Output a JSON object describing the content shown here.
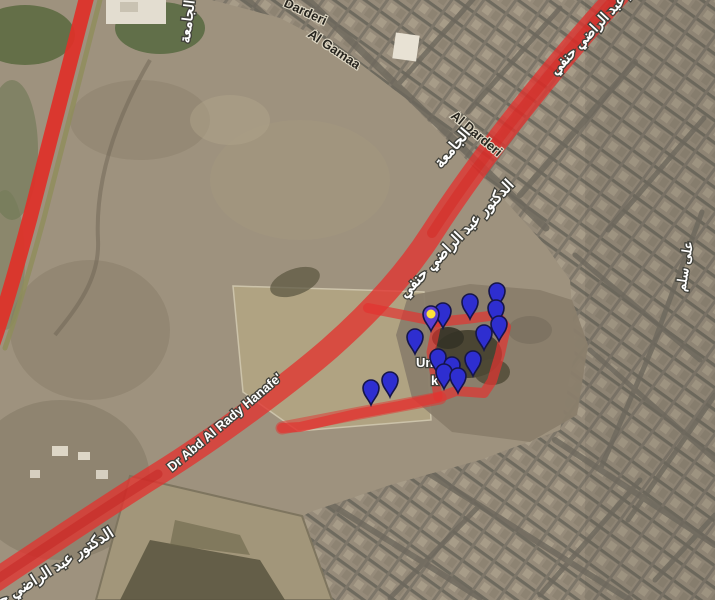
{
  "map": {
    "view": "satellite-with-traffic-overlay",
    "colors": {
      "traffic_red": "#e23330",
      "traffic_red_dark": "#c01c1c",
      "canal_strip": "#8f8d5a",
      "pin_blue": "#2e2ed0",
      "pin_selected_head": "#5a3fd4",
      "pin_selected_center": "#ffe23a",
      "pin_outline": "#15154a"
    },
    "labels": [
      {
        "id": "street-darderi-top",
        "text": "Darderi",
        "x": 283,
        "y": 6,
        "rot": 25,
        "size": 13,
        "style": "dark",
        "dir": "ltr",
        "anchor": "start"
      },
      {
        "id": "street-al-gamaa",
        "text": "Al Gamaa",
        "x": 307,
        "y": 36,
        "rot": 34,
        "size": 13,
        "style": "dark",
        "dir": "ltr",
        "anchor": "start"
      },
      {
        "id": "street-al-darderi",
        "text": "Al Darderi",
        "x": 450,
        "y": 117,
        "rot": 40,
        "size": 13,
        "style": "dark",
        "dir": "ltr",
        "anchor": "start"
      },
      {
        "id": "street-algamaa-arabic-top",
        "text": "الجامعة",
        "x": 192,
        "y": 22,
        "rot": -83,
        "size": 14,
        "style": "light",
        "dir": "rtl",
        "anchor": "middle"
      },
      {
        "id": "street-algamaa-arabic",
        "text": "الجامعة",
        "x": 456,
        "y": 151,
        "rot": -50,
        "size": 15,
        "style": "light",
        "dir": "rtl",
        "anchor": "middle"
      },
      {
        "id": "road-dr-abd-arabic-ne",
        "text": "الدكتور عبد الراضي حنفي",
        "x": 606,
        "y": 22,
        "rot": -47,
        "size": 14,
        "style": "light",
        "dir": "rtl",
        "anchor": "middle"
      },
      {
        "id": "road-dr-abd-arabic-mid",
        "text": "الدكتور عبد الراضي حنفي",
        "x": 460,
        "y": 242,
        "rot": -46,
        "size": 15,
        "style": "light",
        "dir": "rtl",
        "anchor": "middle"
      },
      {
        "id": "road-dr-abd-arabic-sw",
        "text": "الدكتور عبد الراضي حنفي",
        "x": 48,
        "y": 577,
        "rot": -32,
        "size": 15,
        "style": "light",
        "dir": "rtl",
        "anchor": "middle"
      },
      {
        "id": "road-dr-abd-english",
        "text": "Dr Abd Al Rady Hanafe'",
        "x": 172,
        "y": 472,
        "rot": -40,
        "size": 13,
        "style": "light",
        "dir": "ltr",
        "anchor": "start"
      },
      {
        "id": "street-ali-selim",
        "text": "على سلم",
        "x": 689,
        "y": 267,
        "rot": -81,
        "size": 13,
        "style": "light",
        "dir": "rtl",
        "anchor": "middle"
      },
      {
        "id": "place-fragment-un",
        "text": "Un",
        "x": 416,
        "y": 367,
        "rot": 0,
        "size": 13,
        "style": "light",
        "dir": "ltr",
        "anchor": "start"
      },
      {
        "id": "place-fragment-k",
        "text": "k",
        "x": 431,
        "y": 385,
        "rot": 0,
        "size": 13,
        "style": "light",
        "dir": "ltr",
        "anchor": "start"
      }
    ],
    "roads": [
      {
        "name": "west-canal-road",
        "path": "M88,-8 L30,218 C18,262 6,306 -8,346",
        "color": "#e03028",
        "width": 15,
        "opacity": 0.92
      },
      {
        "name": "west-canal-strip",
        "path": "M102,-8 L44,218 C32,262 19,308 5,348",
        "color": "#8f8d5a",
        "width": 5,
        "opacity": 0.8
      },
      {
        "name": "main-avenue",
        "path": "M621,-8 C578,38 492,140 432,233 C407,272 373,310 330,348 C291,382 216,438 158,474 C108,505 38,552 -10,584",
        "color": "#e23330",
        "width": 23,
        "opacity": 0.78
      },
      {
        "name": "main-avenue-core-ne",
        "path": "M621,-8 C578,38 492,140 432,233",
        "color": "#d42420",
        "width": 10,
        "opacity": 0.45
      },
      {
        "name": "main-avenue-core-sw",
        "path": "M158,474 C108,505 38,552 -10,584",
        "color": "#c01c1c",
        "width": 9,
        "opacity": 0.4
      },
      {
        "name": "hill-loop",
        "path": "M368,308 L424,319 L437,322 L466,319 L497,315 L506,327 L500,354 L492,381 L484,393 L456,391 L437,398 L399,406 L356,414 L300,427 L282,428",
        "color": "#e23330",
        "width": 10,
        "opacity": 0.7
      },
      {
        "name": "hill-loop-west",
        "path": "M437,323 L431,352 L435,377 L438,397",
        "color": "#e23330",
        "width": 9,
        "opacity": 0.65
      },
      {
        "name": "hill-loop-south-wide",
        "path": "M282,428 L360,413 L440,398",
        "color": "#e23330",
        "width": 13,
        "opacity": 0.5
      }
    ],
    "markers": [
      {
        "x": 371,
        "y": 388,
        "selected": false
      },
      {
        "x": 390,
        "y": 380,
        "selected": false
      },
      {
        "x": 415,
        "y": 337,
        "selected": false
      },
      {
        "x": 431,
        "y": 314,
        "selected": true
      },
      {
        "x": 443,
        "y": 311,
        "selected": false
      },
      {
        "x": 470,
        "y": 302,
        "selected": false
      },
      {
        "x": 497,
        "y": 291,
        "selected": false
      },
      {
        "x": 496,
        "y": 308,
        "selected": false
      },
      {
        "x": 499,
        "y": 324,
        "selected": false
      },
      {
        "x": 484,
        "y": 333,
        "selected": false
      },
      {
        "x": 473,
        "y": 359,
        "selected": false
      },
      {
        "x": 438,
        "y": 357,
        "selected": false
      },
      {
        "x": 452,
        "y": 365,
        "selected": false
      },
      {
        "x": 444,
        "y": 372,
        "selected": false
      },
      {
        "x": 458,
        "y": 376,
        "selected": false
      }
    ]
  }
}
